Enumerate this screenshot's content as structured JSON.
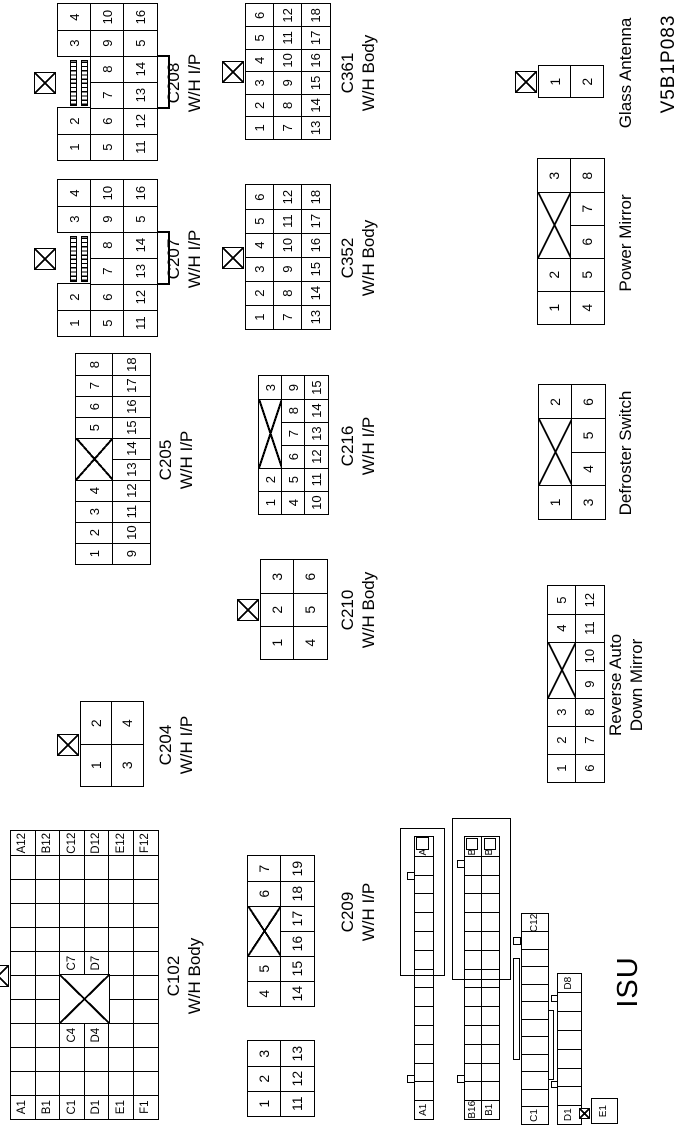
{
  "page": {
    "background": "#ffffff",
    "ink": "#000000"
  },
  "texts": [
    {
      "name": "isu-label",
      "text": "ISU",
      "cx": 145,
      "y": 612,
      "size": 29
    },
    {
      "name": "figure-code",
      "text": "V5B1P083",
      "cx": 1063,
      "y": 658,
      "size": 19
    }
  ],
  "connectors": [
    {
      "id": "C102",
      "label": [
        "C102",
        "W/H Body"
      ],
      "x": 7,
      "y": 10,
      "cw": 24,
      "ch": 24.6,
      "font": 11.5,
      "tab": true,
      "lx": 151,
      "ly": 164,
      "rows": [
        [
          "A1",
          "",
          "",
          "",
          "",
          "",
          "",
          "",
          "",
          "",
          "",
          "A12"
        ],
        [
          "B1",
          "",
          "",
          "",
          "",
          "",
          "",
          "",
          "",
          "",
          "",
          "B12"
        ],
        [
          "C1",
          "",
          "",
          "C4",
          "",
          "",
          "C7",
          "",
          "",
          "",
          "",
          "C12"
        ],
        [
          "D1",
          "",
          "",
          "D4",
          "",
          "",
          "D7",
          "",
          "",
          "",
          "",
          "D12"
        ],
        [
          "E1",
          "",
          "",
          "",
          "",
          "",
          "",
          "",
          "",
          "",
          "",
          "E12"
        ],
        [
          "F1",
          "",
          "",
          "",
          "",
          "",
          "",
          "",
          "",
          "",
          "",
          "F12"
        ]
      ],
      "deco": [
        {
          "t": "xbox",
          "x": 96,
          "y": 49.2,
          "w": 49.7,
          "h": 50.9
        }
      ]
    },
    {
      "id": "C204",
      "label": [
        "C204",
        "W/H I/P"
      ],
      "x": 340,
      "y": 80,
      "cw": 42,
      "ch": 31,
      "font": 14,
      "tab": true,
      "lx": 382,
      "ly": 156,
      "rows": [
        [
          "1",
          "2"
        ],
        [
          "3",
          "4"
        ]
      ]
    },
    {
      "id": "C205",
      "label": [
        "C205",
        "W/H I/P"
      ],
      "x": 562,
      "y": 75,
      "cw": 21,
      "ch": 37,
      "font": 13,
      "lx": 667,
      "ly": 156,
      "rows": [
        [
          "1",
          "2",
          "3",
          "4",
          {
            "x": 2
          },
          "5",
          "6",
          "7",
          "8"
        ],
        [
          "9",
          "10",
          "11",
          "12",
          "13",
          "14",
          "15",
          "16",
          "17",
          "18"
        ]
      ]
    },
    {
      "id": "C207",
      "label": [
        "C207",
        "W/H I/P"
      ],
      "x": 790,
      "y": 57,
      "cw": 26,
      "ch": 33,
      "font": 13,
      "tab": true,
      "lx": 868,
      "ly": 164,
      "rows": [
        [
          "1",
          "2",
          {
            "gap": 2,
            "hatch": true
          },
          "3",
          "4"
        ],
        [
          "5",
          "6",
          "7",
          "8",
          "9",
          "10"
        ],
        [
          "11",
          "12",
          "13",
          "14",
          "5",
          "16"
        ]
      ],
      "deco": [
        {
          "t": "bracket",
          "x": 52,
          "y": 100,
          "w": 54,
          "h": 13
        }
      ]
    },
    {
      "id": "C208",
      "label": [
        "C208",
        "W/H I/P"
      ],
      "x": 966,
      "y": 57,
      "cw": 26,
      "ch": 33,
      "font": 13,
      "tab": true,
      "lx": 1044,
      "ly": 164,
      "rows": [
        [
          "1",
          "2",
          {
            "gap": 2,
            "hatch": true
          },
          "3",
          "4"
        ],
        [
          "5",
          "6",
          "7",
          "8",
          "9",
          "10"
        ],
        [
          "11",
          "12",
          "13",
          "14",
          "5",
          "16"
        ]
      ],
      "deco": [
        {
          "t": "bracket",
          "x": 52,
          "y": 100,
          "w": 54,
          "h": 13
        }
      ]
    },
    {
      "id": "C209",
      "label": [
        "C209",
        "W/H I/P"
      ],
      "x": 10,
      "y": 247,
      "cw": 25,
      "ch": 33,
      "font": 14,
      "lx": 215,
      "ly": 338,
      "rows": [
        [
          "1",
          "2",
          "3",
          {
            "gap": 1.4
          },
          "4",
          "5",
          {
            "x": 2
          },
          "6",
          "7"
        ],
        [
          "11",
          "12",
          "13",
          {
            "gap": 1.4
          },
          "14",
          "15",
          "16",
          "17",
          "18",
          "19"
        ]
      ]
    },
    {
      "id": "C210",
      "label": [
        "C210",
        "W/H Body"
      ],
      "x": 467,
      "y": 260,
      "cw": 33,
      "ch": 33,
      "font": 14,
      "tab": true,
      "lx": 517,
      "ly": 338,
      "rows": [
        [
          "1",
          "2",
          "3"
        ],
        [
          "4",
          "5",
          "6"
        ]
      ]
    },
    {
      "id": "C216",
      "label": [
        "C216",
        "W/H I/P"
      ],
      "x": 612,
      "y": 258,
      "cw": 23,
      "ch": 23,
      "font": 13,
      "lx": 681,
      "ly": 338,
      "rows": [
        [
          "1",
          "2",
          {
            "x": 3
          },
          "3"
        ],
        [
          "4",
          "5",
          "6",
          "7",
          "8",
          "9"
        ],
        [
          "10",
          "11",
          "12",
          "13",
          "14",
          "15"
        ]
      ]
    },
    {
      "id": "C352",
      "label": [
        "C352",
        "W/H Body"
      ],
      "x": 797,
      "y": 245,
      "cw": 24,
      "ch": 28,
      "font": 13,
      "tab": true,
      "lx": 869,
      "ly": 338,
      "rows": [
        [
          "1",
          "2",
          "3",
          "4",
          "5",
          "6"
        ],
        [
          "7",
          "8",
          "9",
          "10",
          "11",
          "12"
        ],
        [
          "13",
          "14",
          "15",
          "16",
          "17",
          "18"
        ]
      ]
    },
    {
      "id": "C361",
      "label": [
        "C361",
        "W/H Body"
      ],
      "x": 987,
      "y": 245,
      "cw": 22.5,
      "ch": 28,
      "font": 13,
      "tab": true,
      "lx": 1054,
      "ly": 338,
      "rows": [
        [
          "1",
          "2",
          "3",
          "4",
          "5",
          "6"
        ],
        [
          "7",
          "8",
          "9",
          "10",
          "11",
          "12"
        ],
        [
          "13",
          "14",
          "15",
          "16",
          "17",
          "18"
        ]
      ]
    },
    {
      "id": "ISU-A",
      "label": [],
      "x": 7,
      "y": 414,
      "cw": 18.8,
      "ch": 18,
      "font": 10,
      "rows": [
        [
          "A1",
          "",
          "",
          "",
          "",
          "",
          "",
          "",
          "",
          "",
          "",
          "",
          "",
          "",
          "A15"
        ]
      ],
      "deco": [
        {
          "t": "rect",
          "x": 144,
          "y": -14,
          "w": 148,
          "h": 45
        },
        {
          "t": "sq",
          "x": 270,
          "y": 2,
          "w": 13,
          "h": 13
        },
        {
          "t": "sq",
          "x": 240,
          "y": -7,
          "w": 8,
          "h": 8
        },
        {
          "t": "sq",
          "x": 37,
          "y": -7,
          "w": 8,
          "h": 8
        }
      ]
    },
    {
      "id": "ISU-B",
      "label": [],
      "x": 7,
      "y": 464,
      "cw": 18.8,
      "ch": 17,
      "font": 10,
      "rows": [
        [
          "B16",
          "",
          "",
          "",
          "",
          "",
          "",
          "",
          "",
          "",
          "",
          "",
          "",
          "",
          "B30"
        ],
        [
          "B1",
          "",
          "",
          "",
          "",
          "",
          "",
          "",
          "",
          "",
          "",
          "",
          "",
          "",
          "B15"
        ]
      ],
      "deco": [
        {
          "t": "rect",
          "x": 140,
          "y": -12,
          "w": 162,
          "h": 59
        },
        {
          "t": "sq",
          "x": 270,
          "y": 2,
          "w": 12,
          "h": 12
        },
        {
          "t": "sq",
          "x": 270,
          "y": 20,
          "w": 12,
          "h": 12
        },
        {
          "t": "sq",
          "x": 252,
          "y": -7,
          "w": 8,
          "h": 8
        },
        {
          "t": "sq",
          "x": 37,
          "y": -7,
          "w": 8,
          "h": 8
        }
      ]
    },
    {
      "id": "ISU-C",
      "label": [],
      "x": 2,
      "y": 521,
      "cw": 17.5,
      "ch": 26,
      "font": 10,
      "rows": [
        [
          "C1",
          "",
          "",
          "",
          "",
          "",
          "",
          "",
          "",
          "",
          "",
          "C12"
        ]
      ],
      "deco": [
        {
          "t": "rect",
          "x": 65,
          "y": -8,
          "w": 102,
          "h": 7
        },
        {
          "t": "sq",
          "x": 180,
          "y": -8,
          "w": 8,
          "h": 8
        }
      ]
    },
    {
      "id": "ISU-D",
      "label": [],
      "x": 2,
      "y": 557,
      "cw": 18.8,
      "ch": 23,
      "font": 10,
      "rows": [
        [
          "D1",
          "",
          "",
          "",
          "",
          "",
          "",
          "D8"
        ]
      ],
      "deco": [
        {
          "t": "rect",
          "x": 45,
          "y": -9,
          "w": 70,
          "h": 6
        },
        {
          "t": "sq",
          "x": 123,
          "y": -6,
          "w": 7,
          "h": 7
        },
        {
          "t": "sq",
          "x": 37,
          "y": -6,
          "w": 7,
          "h": 7
        }
      ]
    },
    {
      "id": "ISU-E",
      "label": [],
      "x": 3,
      "y": 591,
      "cw": 24,
      "ch": 25,
      "font": 10,
      "rows": [
        [
          "E1"
        ]
      ],
      "deco": [
        {
          "t": "xsq",
          "x": 5,
          "y": -12,
          "w": 11,
          "h": 11
        }
      ]
    },
    {
      "id": "ReverseAutoDownMirror",
      "label": [
        "Reverse Auto",
        "Down Mirror"
      ],
      "x": 344,
      "y": 547,
      "cw": 28,
      "ch": 28,
      "font": 13,
      "lx": 442,
      "ly": 606,
      "rows": [
        [
          "1",
          "2",
          "3",
          {
            "x": 2
          },
          "4",
          "5"
        ],
        [
          "6",
          "7",
          "8",
          "9",
          "10",
          "11",
          "12"
        ]
      ]
    },
    {
      "id": "DefrosterSwitch",
      "label": [
        "Defroster Switch"
      ],
      "x": 607,
      "y": 538,
      "cw": 33.5,
      "ch": 33,
      "font": 14,
      "lx": 674,
      "ly": 616,
      "rows": [
        [
          "1",
          {
            "x": 2
          },
          "2"
        ],
        [
          "3",
          "4",
          "5",
          "6"
        ]
      ]
    },
    {
      "id": "PowerMirror",
      "label": [
        "Power Mirror"
      ],
      "x": 802,
      "y": 537,
      "cw": 33,
      "ch": 33,
      "font": 14,
      "lx": 884,
      "ly": 616,
      "rows": [
        [
          "1",
          "2",
          {
            "x": 2
          },
          "3"
        ],
        [
          "4",
          "5",
          "6",
          "7",
          "8"
        ]
      ]
    },
    {
      "id": "GlassAntenna",
      "label": [
        "Glass Antenna"
      ],
      "x": 1029,
      "y": 538,
      "cw": 31,
      "ch": 32,
      "font": 14,
      "tab": true,
      "lx": 1054,
      "ly": 616,
      "rows": [
        [
          "1"
        ],
        [
          "2"
        ]
      ]
    }
  ]
}
